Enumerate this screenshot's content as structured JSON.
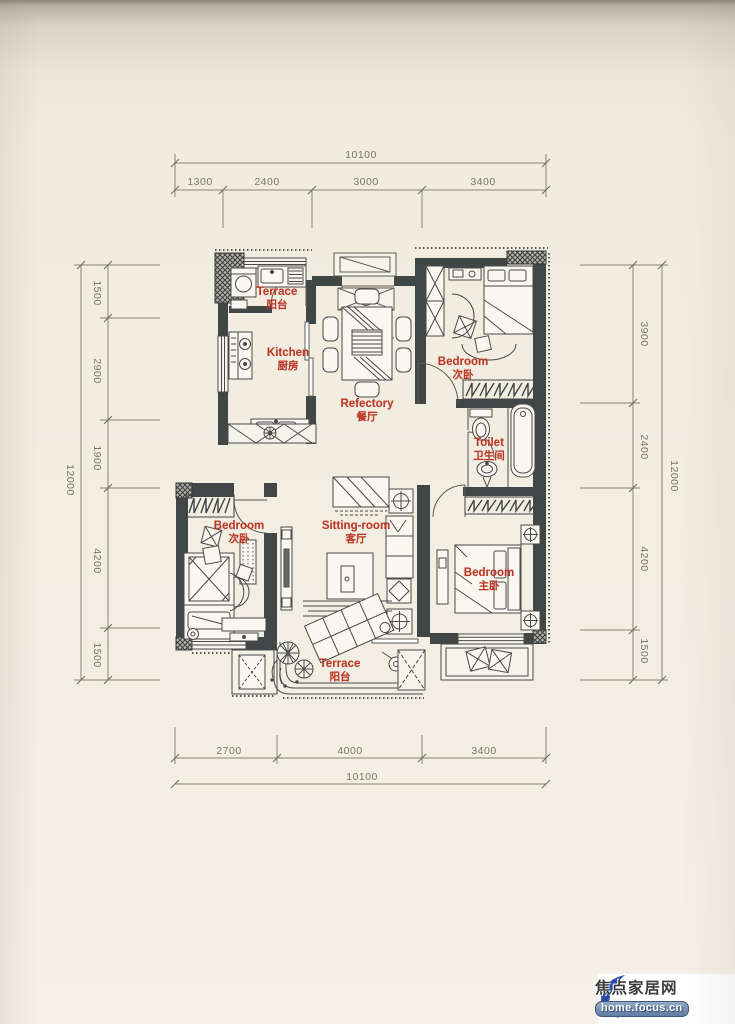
{
  "dims": {
    "top": {
      "total": "10100",
      "segments": [
        "1300",
        "2400",
        "3000",
        "3400"
      ]
    },
    "bottom": {
      "total": "10100",
      "segments": [
        "2700",
        "4000",
        "3400"
      ]
    },
    "left": {
      "total": "12000",
      "segments": [
        "1500",
        "2900",
        "1900",
        "4200",
        "1500"
      ]
    },
    "right": {
      "total": "12000",
      "segments": [
        "3900",
        "2400",
        "4200",
        "1500"
      ]
    }
  },
  "rooms": [
    {
      "id": "terrace-top",
      "en": "Terrace",
      "cn": "阳台"
    },
    {
      "id": "kitchen",
      "en": "Kitchen",
      "cn": "厨房"
    },
    {
      "id": "refectory",
      "en": "Refectory",
      "cn": "餐厅"
    },
    {
      "id": "bedroom-second",
      "en": "Bedroom",
      "cn": "次卧"
    },
    {
      "id": "toilet",
      "en": "Toilet",
      "cn": "卫生间"
    },
    {
      "id": "bedroom-third",
      "en": "Bedroom",
      "cn": "次卧"
    },
    {
      "id": "sitting-room",
      "en": "Sitting-room",
      "cn": "客厅"
    },
    {
      "id": "bedroom-master",
      "en": "Bedroom",
      "cn": "主卧"
    },
    {
      "id": "terrace-bottom",
      "en": "Terrace",
      "cn": "阳台"
    }
  ],
  "watermark": {
    "site_name": "焦点家居网",
    "site_url": "home.focus.cn"
  },
  "colors": {
    "label_red": "#bb3726",
    "wall": "#414747",
    "paper": "#f2eee3",
    "dim_text": "#7c7566",
    "watermark_blue": "#2a4da8",
    "watermark_red": "#e01602"
  }
}
